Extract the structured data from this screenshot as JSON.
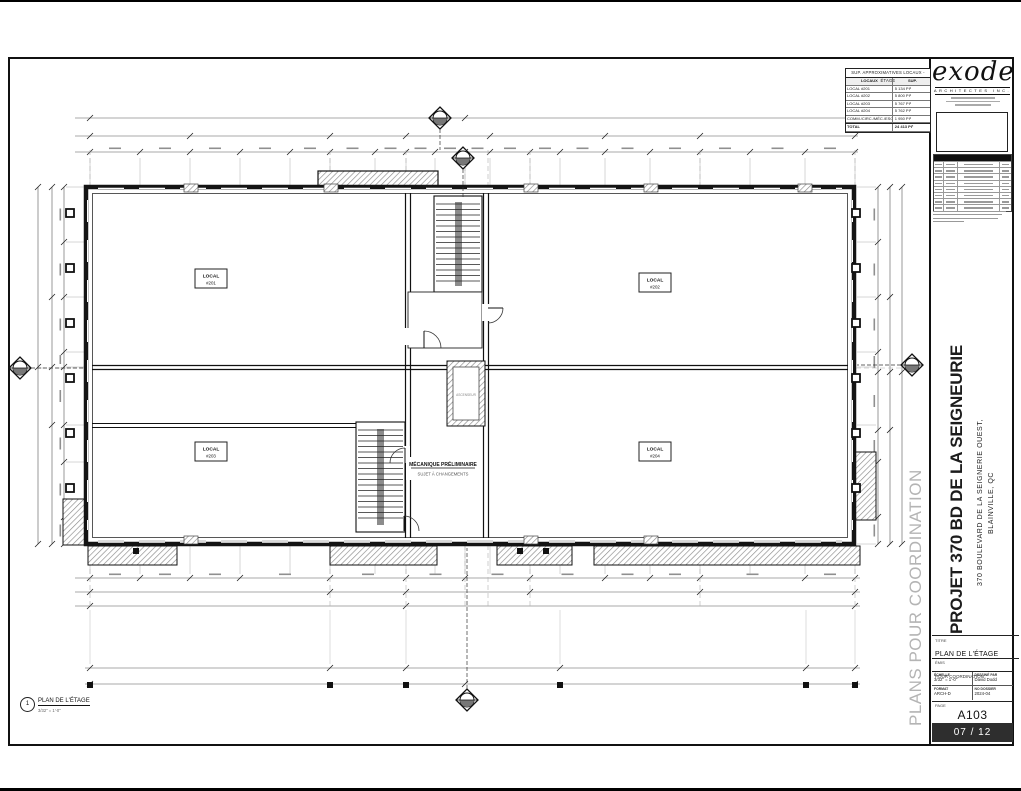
{
  "watermark": "PLANS POUR COORDINATION",
  "logo": {
    "name": "exode",
    "subtitle": "ARCHITECTES INC."
  },
  "area_table": {
    "title": "SUP. APPROXIMATIVES LOCAUX - ÉTAGE",
    "col_local": "LOCAUX",
    "col_sup": "SUP.",
    "rows": [
      {
        "label": "LOCAL #201",
        "value": "5 134 PI²"
      },
      {
        "label": "LOCAL #202",
        "value": "5 800 PI²"
      },
      {
        "label": "LOCAL #203",
        "value": "5 767 PI²"
      },
      {
        "label": "LOCAL #204",
        "value": "5 762 PI²"
      },
      {
        "label": "COMM./CIRC./MÉC./ESCALIERS",
        "value": "1 950 PI²"
      }
    ],
    "total_label": "TOTAL",
    "total_value": "24 413 PI²"
  },
  "plan": {
    "locals": [
      {
        "line1": "LOCAL",
        "line2": "#201"
      },
      {
        "line1": "LOCAL",
        "line2": "#202"
      },
      {
        "line1": "LOCAL",
        "line2": "#203"
      },
      {
        "line1": "LOCAL",
        "line2": "#204"
      }
    ],
    "mech_line1": "MÉCANIQUE PRÉLIMINAIRE",
    "mech_line2": "SUJET À CHANGEMENTS",
    "elevator": "ASCENSEUR",
    "view_number": "1",
    "view_title": "PLAN DE L'ÉTAGE",
    "view_scale": "3/32\" = 1'-0\""
  },
  "titleblock": {
    "project_title": "PROJET 370 BD DE LA SEIGNEURIE",
    "address_line1": "370 BOULEVARD DE LA SEIGNERIE OUEST,",
    "address_line2": "BLAINVILLE, QC",
    "titre_label": "TITRE",
    "titre_value": "PLAN DE L'ÉTAGE",
    "emis_label": "ÉMIS",
    "emis_value": "POUR COORDINATION",
    "echelle_label": "ÉCHELLE",
    "echelle_value": "3/32\" = 1'-0\"",
    "dessine_label": "DESSINÉ PAR",
    "dessine_value": "David Dodd",
    "format_label": "FORMAT",
    "format_value": "ARCH-D",
    "dossier_label": "NO DOSSIER",
    "dossier_value": "2024-04",
    "page_label": "PAGE",
    "sheet_number": "A103",
    "page_count": "07 / 12",
    "revision_rows": 8
  }
}
